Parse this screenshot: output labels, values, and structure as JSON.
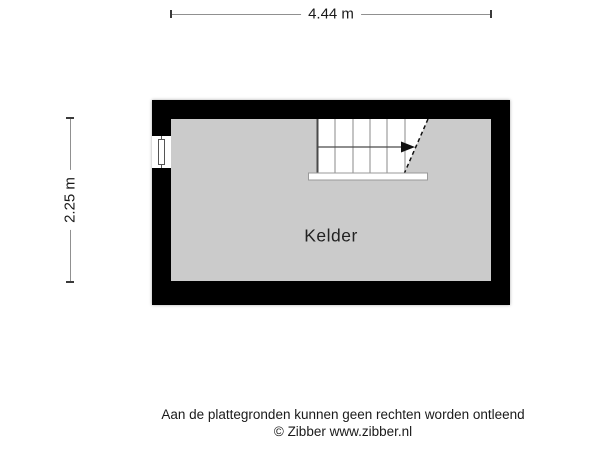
{
  "dimensions": {
    "width_label": "4.44 m",
    "height_label": "2.25 m"
  },
  "room": {
    "name": "Kelder"
  },
  "symbols": {
    "stairs_icon": "staircase with up-direction arrow and cut line",
    "window_icon": "window in left wall"
  },
  "footer": {
    "disclaimer": "Aan de plattegronden kunnen geen rechten worden ontleend",
    "copyright": "© Zibber www.zibber.nl"
  },
  "colors": {
    "background": "#ffffff",
    "wall": "#000000",
    "floor": "#cbcbcb",
    "dimension_line": "#909090",
    "dimension_tick": "#3a3a3a",
    "text": "#1a1a1a"
  }
}
